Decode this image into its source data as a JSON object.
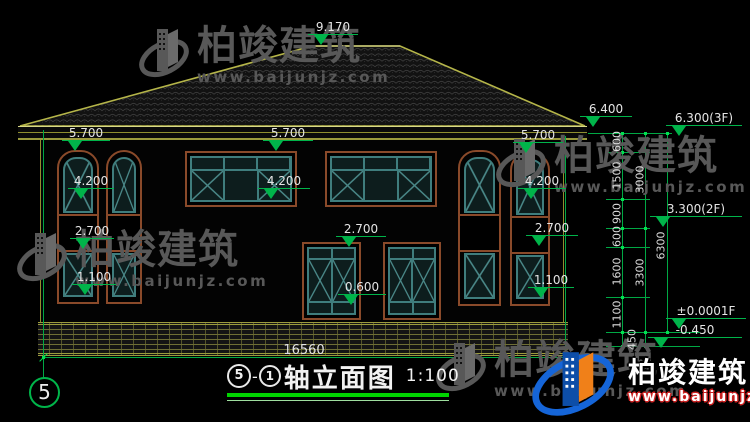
{
  "brand": {
    "name": "柏竣建筑",
    "url": "www.baijunjz.com"
  },
  "title_block": {
    "axis_start": "5",
    "separator": "-",
    "axis_end": "1",
    "name": "轴立面图",
    "scale": "1:100"
  },
  "grid_bubble": "5",
  "overall_dimension": "16560",
  "facade_markers": [
    {
      "label": "9.170",
      "x": 308,
      "y": 35,
      "w": 50
    },
    {
      "label": "6.400",
      "x": 580,
      "y": 117,
      "w": 52
    },
    {
      "label": "5.700",
      "x": 62,
      "y": 141,
      "w": 48
    },
    {
      "label": "5.700",
      "x": 263,
      "y": 141,
      "w": 50
    },
    {
      "label": "5.700",
      "x": 513,
      "y": 143,
      "w": 50
    },
    {
      "label": "4.200",
      "x": 68,
      "y": 189,
      "w": 46
    },
    {
      "label": "4.200",
      "x": 258,
      "y": 189,
      "w": 52
    },
    {
      "label": "4.200",
      "x": 518,
      "y": 189,
      "w": 48
    },
    {
      "label": "2.700",
      "x": 70,
      "y": 239,
      "w": 44
    },
    {
      "label": "2.700",
      "x": 336,
      "y": 237,
      "w": 50
    },
    {
      "label": "2.700",
      "x": 526,
      "y": 236,
      "w": 52
    },
    {
      "label": "1.100",
      "x": 72,
      "y": 285,
      "w": 44
    },
    {
      "label": "0.600",
      "x": 338,
      "y": 295,
      "w": 48
    },
    {
      "label": "1.100",
      "x": 528,
      "y": 288,
      "w": 46
    }
  ],
  "right_markers": [
    {
      "label": "6.300(3F)",
      "x": 666,
      "y": 126,
      "w": 76
    },
    {
      "label": "3.300(2F)",
      "x": 650,
      "y": 217,
      "w": 92
    },
    {
      "label": "±0.0001F",
      "x": 666,
      "y": 319,
      "w": 80
    },
    {
      "label": "-0.450",
      "x": 648,
      "y": 338,
      "w": 94
    }
  ],
  "chain_dimensions": [
    {
      "label": "600",
      "x": 617,
      "y": 142
    },
    {
      "label": "1500",
      "x": 617,
      "y": 176
    },
    {
      "label": "900",
      "x": 617,
      "y": 214
    },
    {
      "label": "600",
      "x": 617,
      "y": 237
    },
    {
      "label": "1600",
      "x": 617,
      "y": 272
    },
    {
      "label": "1100",
      "x": 617,
      "y": 315
    },
    {
      "label": "450",
      "x": 632,
      "y": 340
    },
    {
      "label": "3000",
      "x": 640,
      "y": 180
    },
    {
      "label": "3300",
      "x": 640,
      "y": 273
    },
    {
      "label": "6300",
      "x": 661,
      "y": 246
    }
  ],
  "watermarks": [
    {
      "x": 138,
      "y": 24
    },
    {
      "x": 16,
      "y": 228
    },
    {
      "x": 495,
      "y": 134
    },
    {
      "x": 435,
      "y": 338
    }
  ]
}
